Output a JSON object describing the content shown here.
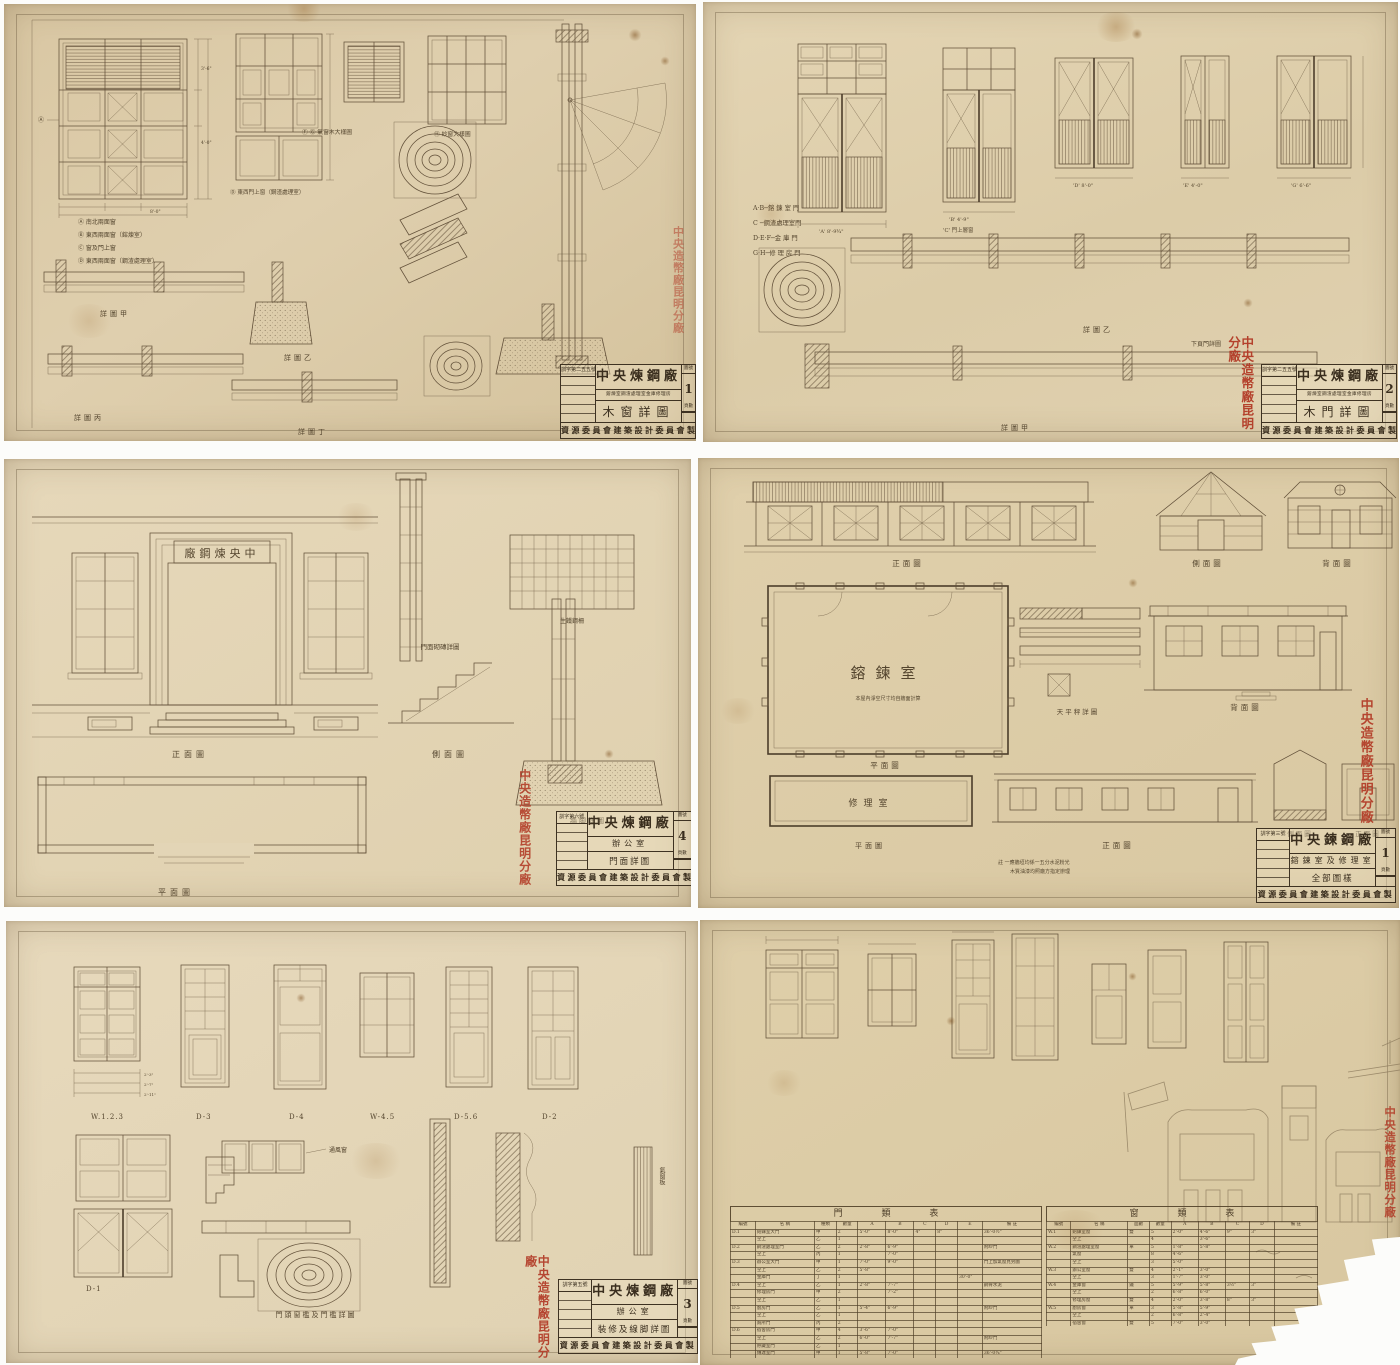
{
  "stamp_text": "中央造幣廠昆明分廠",
  "tb_labels": {
    "no": "圖號",
    "pages": "頁數"
  },
  "panels": {
    "p1": {
      "labels": {
        "markA": "Ⓐ",
        "lblFG": "Ⓕ Ⓖ 氣窗木大樣圖",
        "lblH": "Ⓗ 紗窗大樣圖",
        "lblD": "Ⓓ 東西門上窗（鋼渣處理室）",
        "legend1": "Ⓐ 南北兩面窗",
        "legend2": "Ⓑ 東西兩面窗（鎔煉室）",
        "legend3": "Ⓒ 窗及門上窗",
        "legend4": "Ⓓ 東西兩面窗（鋼渣處理室）",
        "sec1": "詳圖甲",
        "sec2": "詳圖乙",
        "sec3": "詳圖丙",
        "sec4": "詳圖丁",
        "dim1": "3'-6\"",
        "dim2": "4'-0\"",
        "dim3": "8'-0\""
      },
      "tb": {
        "doc_no": "訓字第二五五號",
        "org": "中央煉鋼廠",
        "sub": "鎔煉室鋼渣處理室金庫修理房",
        "drawing": "木窗詳圖",
        "sheet_no": "1",
        "maker": "資源委員會建築設計委員會製"
      }
    },
    "p2": {
      "labels": {
        "legendAB": "A·B─鎔 鍊 室 門",
        "legendC": "C  ─鋼渣處理室門",
        "legendDEF": "D·E·F─金 庫 門",
        "legendGH": "G·H─修 理 房 門",
        "lblC": "'C' 門上層窗",
        "note": "下頁門詳圖",
        "sec1": "詳圖甲",
        "sec2": "詳圖乙"
      },
      "dims": [
        "'A' 8'-9¾\"",
        "'B' 4'-9\"",
        "'D' 8'-0\"",
        "'E' 4'-0\"",
        "'G' 6'-6\""
      ],
      "tb": {
        "doc_no": "訓字第二五五號",
        "org": "中央煉鋼廠",
        "sub": "鎔煉室鋼渣處理室金庫修理房",
        "drawing": "木門詳圖",
        "sheet_no": "2",
        "maker": "資源委員會建築設計委員會製"
      }
    },
    "p3": {
      "labels": {
        "sign": "廠鋼煉央中",
        "front": "正面圖",
        "side": "側面圖",
        "plan": "平面圖",
        "plate": "生鐵鋼柵",
        "brick": "門面砌磚詳圖",
        "foot": "牆脚詳圖"
      },
      "tb": {
        "doc_no": "訓字第六號",
        "org": "中央煉鋼廠",
        "sub": "辦公室",
        "drawing": "門面詳圖",
        "sheet_no": "4",
        "maker": "資源委員會建築設計委員會製"
      }
    },
    "p4": {
      "labels": {
        "elev1": "正面圖",
        "elev2": "側面圖",
        "elev3": "背面圖",
        "elev4": "背面圖",
        "elev5": "正面圖",
        "plan1": "平面圖",
        "plan2": "平面圖",
        "room1": "鎔鍊室",
        "room2": "修理室",
        "scale": "天平秤詳圖",
        "sec1": "側面圖",
        "sec2": "正面圖",
        "note1": "本屋內淨空尺寸均自牆面計算",
        "note2": "註 一應牆垣均係一五分水泥粉光",
        "note3": "木質油漆均照廠方指定辦理"
      },
      "tb": {
        "doc_no": "訓字第三號",
        "org": "中央鍊鋼廠",
        "sub": "鎔鍊室及修理室",
        "drawing": "全部圖樣",
        "sheet_no": "1",
        "maker": "資源委員會建築設計委員會製"
      }
    },
    "p5": {
      "labels": {
        "w123": "W.1.2.3",
        "d3": "D-3",
        "d4": "D-4",
        "w45": "W-4.5",
        "d56": "D-5.6",
        "d2": "D-2",
        "d1": "D-1",
        "vent": "通風窗",
        "ventboard": "氣窗板",
        "detail": "門頭窗檻及門檻詳圖",
        "dim1": "2'-3\"",
        "dim2": "2'-7\"",
        "dim3": "2'-11\""
      },
      "tb": {
        "doc_no": "訓字第五號",
        "org": "中央煉鋼廠",
        "sub": "辦公室",
        "drawing": "裝修及線脚詳圖",
        "sheet_no": "3",
        "maker": "資源委員會建築設計委員會製"
      }
    },
    "p6": {
      "door_table": {
        "title": "門 類 表",
        "headers": [
          "編號",
          "名 稱",
          "種類",
          "數量",
          "A",
          "B",
          "C",
          "D",
          "E",
          "備 註"
        ],
        "rows": [
          [
            "D.1",
            "鎔鍊室大門",
            "甲",
            "2",
            "5'-0\"",
            "8'-0\"",
            "4\"",
            "8\"",
            "",
            "36'-0½\""
          ],
          [
            "",
            "仝上",
            "乙",
            "1",
            "",
            "",
            "",
            "",
            "",
            ""
          ],
          [
            "D.2",
            "鋼渣處理室門",
            "乙",
            "2",
            "2'-8\"",
            "6'-9\"",
            "",
            "",
            "",
            "附紗門"
          ],
          [
            "",
            "仝上",
            "丙",
            "1",
            "",
            "7'-0\"",
            "",
            "",
            "",
            ""
          ],
          [
            "D.3",
            "辦公室大門",
            "甲",
            "1",
            "7'-0\"",
            "9'-0\"",
            "",
            "",
            "",
            "門上加氣窗見另圖"
          ],
          [
            "",
            "仝上",
            "乙",
            "2",
            "5'-8\"",
            "",
            "",
            "",
            "",
            ""
          ],
          [
            "",
            "金庫門",
            "丁",
            "1",
            "",
            "",
            "",
            "",
            "30'-0\"",
            ""
          ],
          [
            "D.4",
            "仝上",
            "乙",
            "1",
            "2'-8\"",
            "7'-7\"",
            "",
            "",
            "",
            "鋼骨水泥"
          ],
          [
            "",
            "修理房門",
            "甲",
            "2",
            "",
            "7'-2\"",
            "",
            "",
            "",
            ""
          ],
          [
            "",
            "仝上",
            "乙",
            "1",
            "",
            "",
            "",
            "",
            "",
            ""
          ],
          [
            "D.5",
            "廚房門",
            "乙",
            "1",
            "5'-4\"",
            "6'-9\"",
            "",
            "",
            "",
            "附紗門"
          ],
          [
            "",
            "仝上",
            "乙",
            "1",
            "",
            "",
            "",
            "",
            "",
            ""
          ],
          [
            "",
            "廁所門",
            "丙",
            "2",
            "",
            "",
            "",
            "",
            "",
            ""
          ],
          [
            "D.6",
            "宿舍房門",
            "甲",
            "4",
            "3'-6\"",
            "7'-0\"",
            "",
            "",
            "",
            ""
          ],
          [
            "",
            "仝上",
            "乙",
            "2",
            "6'-0\"",
            "7'-7\"",
            "",
            "",
            "",
            "附紗門"
          ],
          [
            "",
            "貯藏室門",
            "乙",
            "1",
            "",
            "",
            "",
            "",
            "",
            ""
          ],
          [
            "",
            "傳達室門",
            "甲",
            "1",
            "5'-8\"",
            "7'-0\"",
            "",
            "",
            "",
            "36'-0¾\""
          ],
          [
            "",
            "仝上",
            "乙",
            "1",
            "",
            "",
            "",
            "",
            "",
            ""
          ],
          [
            "D.7",
            "圍牆大門",
            "乙",
            "1",
            "2'-8\"",
            "",
            "",
            "",
            "",
            "見圍牆詳圖"
          ]
        ]
      },
      "window_table": {
        "title": "窗 類 表",
        "headers": [
          "編號",
          "名 稱",
          "面數",
          "數量",
          "A",
          "B",
          "C",
          "D",
          "備 註"
        ],
        "rows": [
          [
            "W.1",
            "鎔鍊室窗",
            "雙",
            "5",
            "2'-0\"",
            "4'-6\"",
            "9\"",
            "3\"",
            ""
          ],
          [
            "",
            "仝上",
            "",
            "4",
            "",
            "3'-6\"",
            "",
            "",
            ""
          ],
          [
            "W.2",
            "鋼渣處理室窗",
            "單",
            "5",
            "1'-8\"",
            "5'-8\"",
            "",
            "",
            ""
          ],
          [
            "",
            "氣窗",
            "",
            "8",
            "4'-6\"",
            "",
            "",
            "",
            ""
          ],
          [
            "",
            "仝上",
            "",
            "3",
            "5'-0\"",
            "",
            "",
            "",
            ""
          ],
          [
            "W.3",
            "辦公室窗",
            "雙",
            "4",
            "2'-1\"",
            "3'-0\"",
            "",
            "",
            ""
          ],
          [
            "",
            "仝上",
            "",
            "3",
            "1'-7\"",
            "3'-0\"",
            "",
            "",
            ""
          ],
          [
            "W.4",
            "金庫窗",
            "鐵",
            "5",
            "5'-9\"",
            "5'-8\"",
            "3½\"",
            "3\"",
            ""
          ],
          [
            "",
            "仝上",
            "",
            "2",
            "6'-8\"",
            "6'-0\"",
            "",
            "",
            ""
          ],
          [
            "",
            "修理房窗",
            "雙",
            "4",
            "2'-0\"",
            "3'-8\"",
            "8\"",
            "3\"",
            ""
          ],
          [
            "W.5",
            "廚房窗",
            "單",
            "3",
            "5'-8\"",
            "5'-9\"",
            "",
            "",
            ""
          ],
          [
            "",
            "仝上",
            "",
            "2",
            "6'-8\"",
            "2'-4\"",
            "",
            "",
            ""
          ],
          [
            "",
            "宿舍窗",
            "雙",
            "5",
            "7'-0\"",
            "3'-0\"",
            "",
            "",
            ""
          ],
          [
            "",
            "仝上",
            "",
            "4",
            "2'-0\"",
            "3'-8\"",
            "",
            "",
            ""
          ]
        ]
      }
    }
  }
}
